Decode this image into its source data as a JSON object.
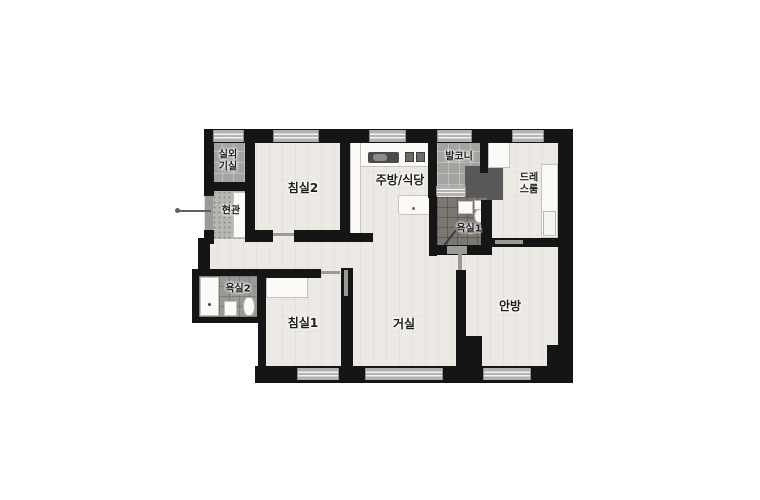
{
  "floorplan": {
    "type": "apartment-floor-plan",
    "rooms": {
      "outdoor_unit": {
        "label": "실외\n기실"
      },
      "entrance": {
        "label": "현관"
      },
      "bedroom2": {
        "label": "침실2"
      },
      "kitchen_dining": {
        "label": "주방/식당"
      },
      "balcony": {
        "label": "발코니"
      },
      "dress_room": {
        "label": "드레\n스룸"
      },
      "bathroom1": {
        "label": "욕실1"
      },
      "bathroom2": {
        "label": "욕실2"
      },
      "bedroom1": {
        "label": "침실1"
      },
      "living_room": {
        "label": "거실"
      },
      "master_bedroom": {
        "label": "안방"
      }
    },
    "colors": {
      "wall": "#151515",
      "wood_floor": "#edeae5",
      "tile_floor": "#a4a3a0",
      "entrance_tile": "#b8b6b3",
      "bathroom1_tile": "#7d7772",
      "bathroom2_tile": "#9b9996",
      "dark_storage": "#585858",
      "window": "#b2b2b1",
      "fixture": "#fbfaf7",
      "background": "#ffffff"
    }
  }
}
